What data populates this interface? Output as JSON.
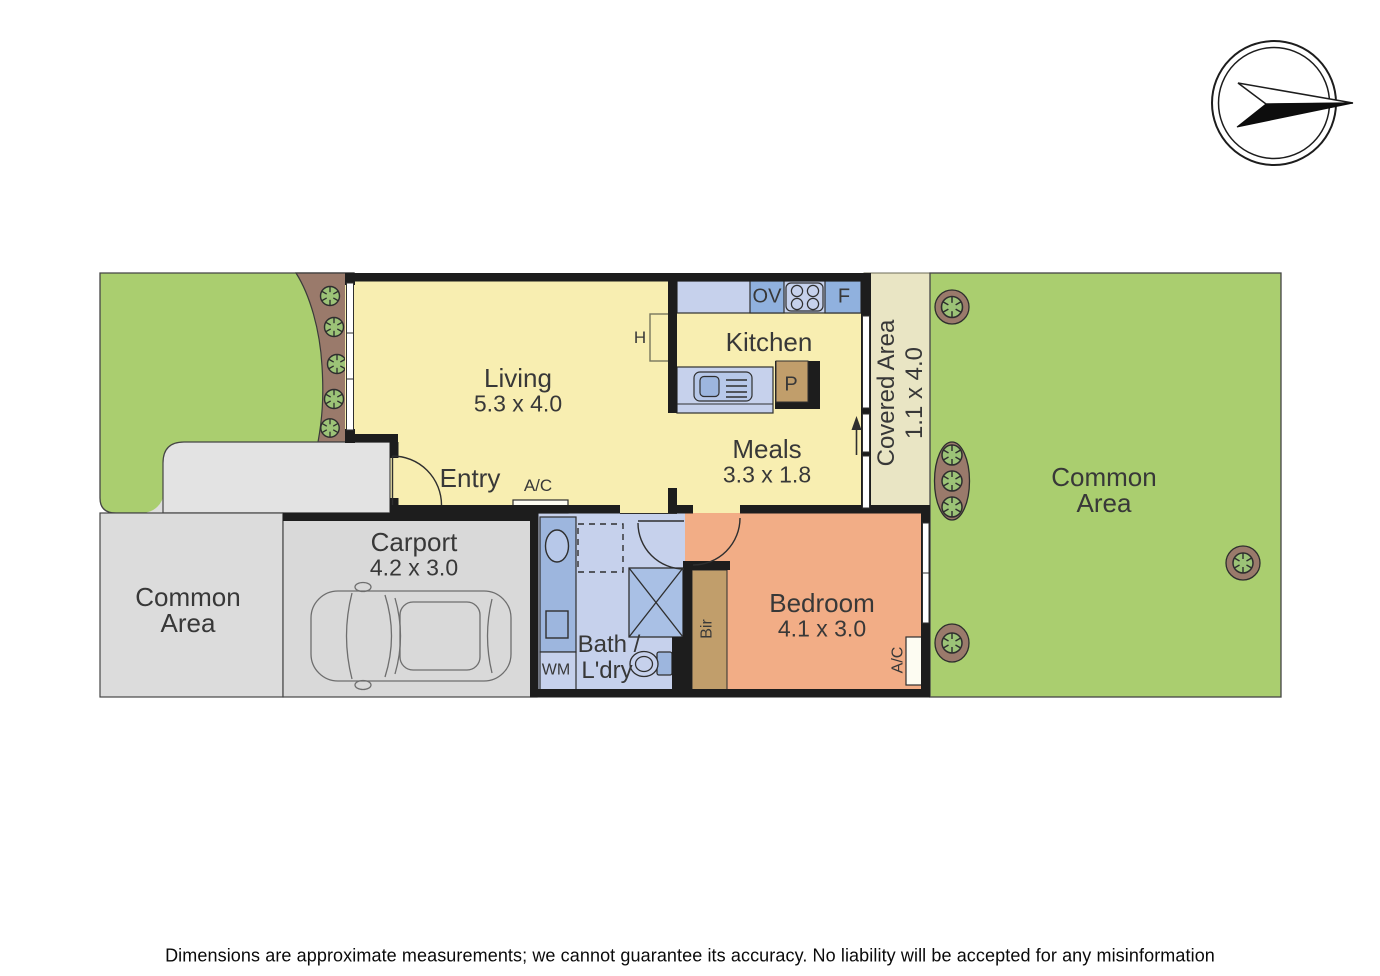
{
  "plan": {
    "rooms": {
      "living": {
        "name": "Living",
        "dims": "5.3 x 4.0"
      },
      "kitchen": {
        "name": "Kitchen"
      },
      "meals": {
        "name": "Meals",
        "dims": "3.3 x 1.8"
      },
      "covered_area": {
        "name": "Covered Area",
        "dims": "1.1 x 4.0"
      },
      "bedroom": {
        "name": "Bedroom",
        "dims": "4.1 x 3.0"
      },
      "bath_laundry": {
        "name_line1": "Bath /",
        "name_line2": "L'dry"
      },
      "carport": {
        "name": "Carport",
        "dims": "4.2 x 3.0"
      },
      "entry": {
        "name": "Entry"
      },
      "common_area": {
        "line1": "Common",
        "line2": "Area"
      }
    },
    "fixture_labels": {
      "oven": "OV",
      "fridge": "F",
      "pantry": "P",
      "hot_water": "H",
      "washing_machine": "WM",
      "built_in_robe": "Bir",
      "air_conditioner": "A/C"
    },
    "colors": {
      "grass": "#aace6f",
      "garden_bed": "#9a7a6b",
      "shrub": "#9cc377",
      "floor_main": "#f8eeb1",
      "covered_area": "#e9e5c4",
      "concrete": "#dcdcdc",
      "bath_floor": "#c6d1ec",
      "fixture_blue": "#9db6de",
      "appliance_blue": "#90b1de",
      "bedroom_floor": "#f2ad86",
      "timber": "#c19e6b",
      "wall": "#1d1d1d"
    }
  },
  "disclaimer": "Dimensions are approximate measurements; we cannot guarantee its accuracy. No liability will be accepted for any misinformation"
}
